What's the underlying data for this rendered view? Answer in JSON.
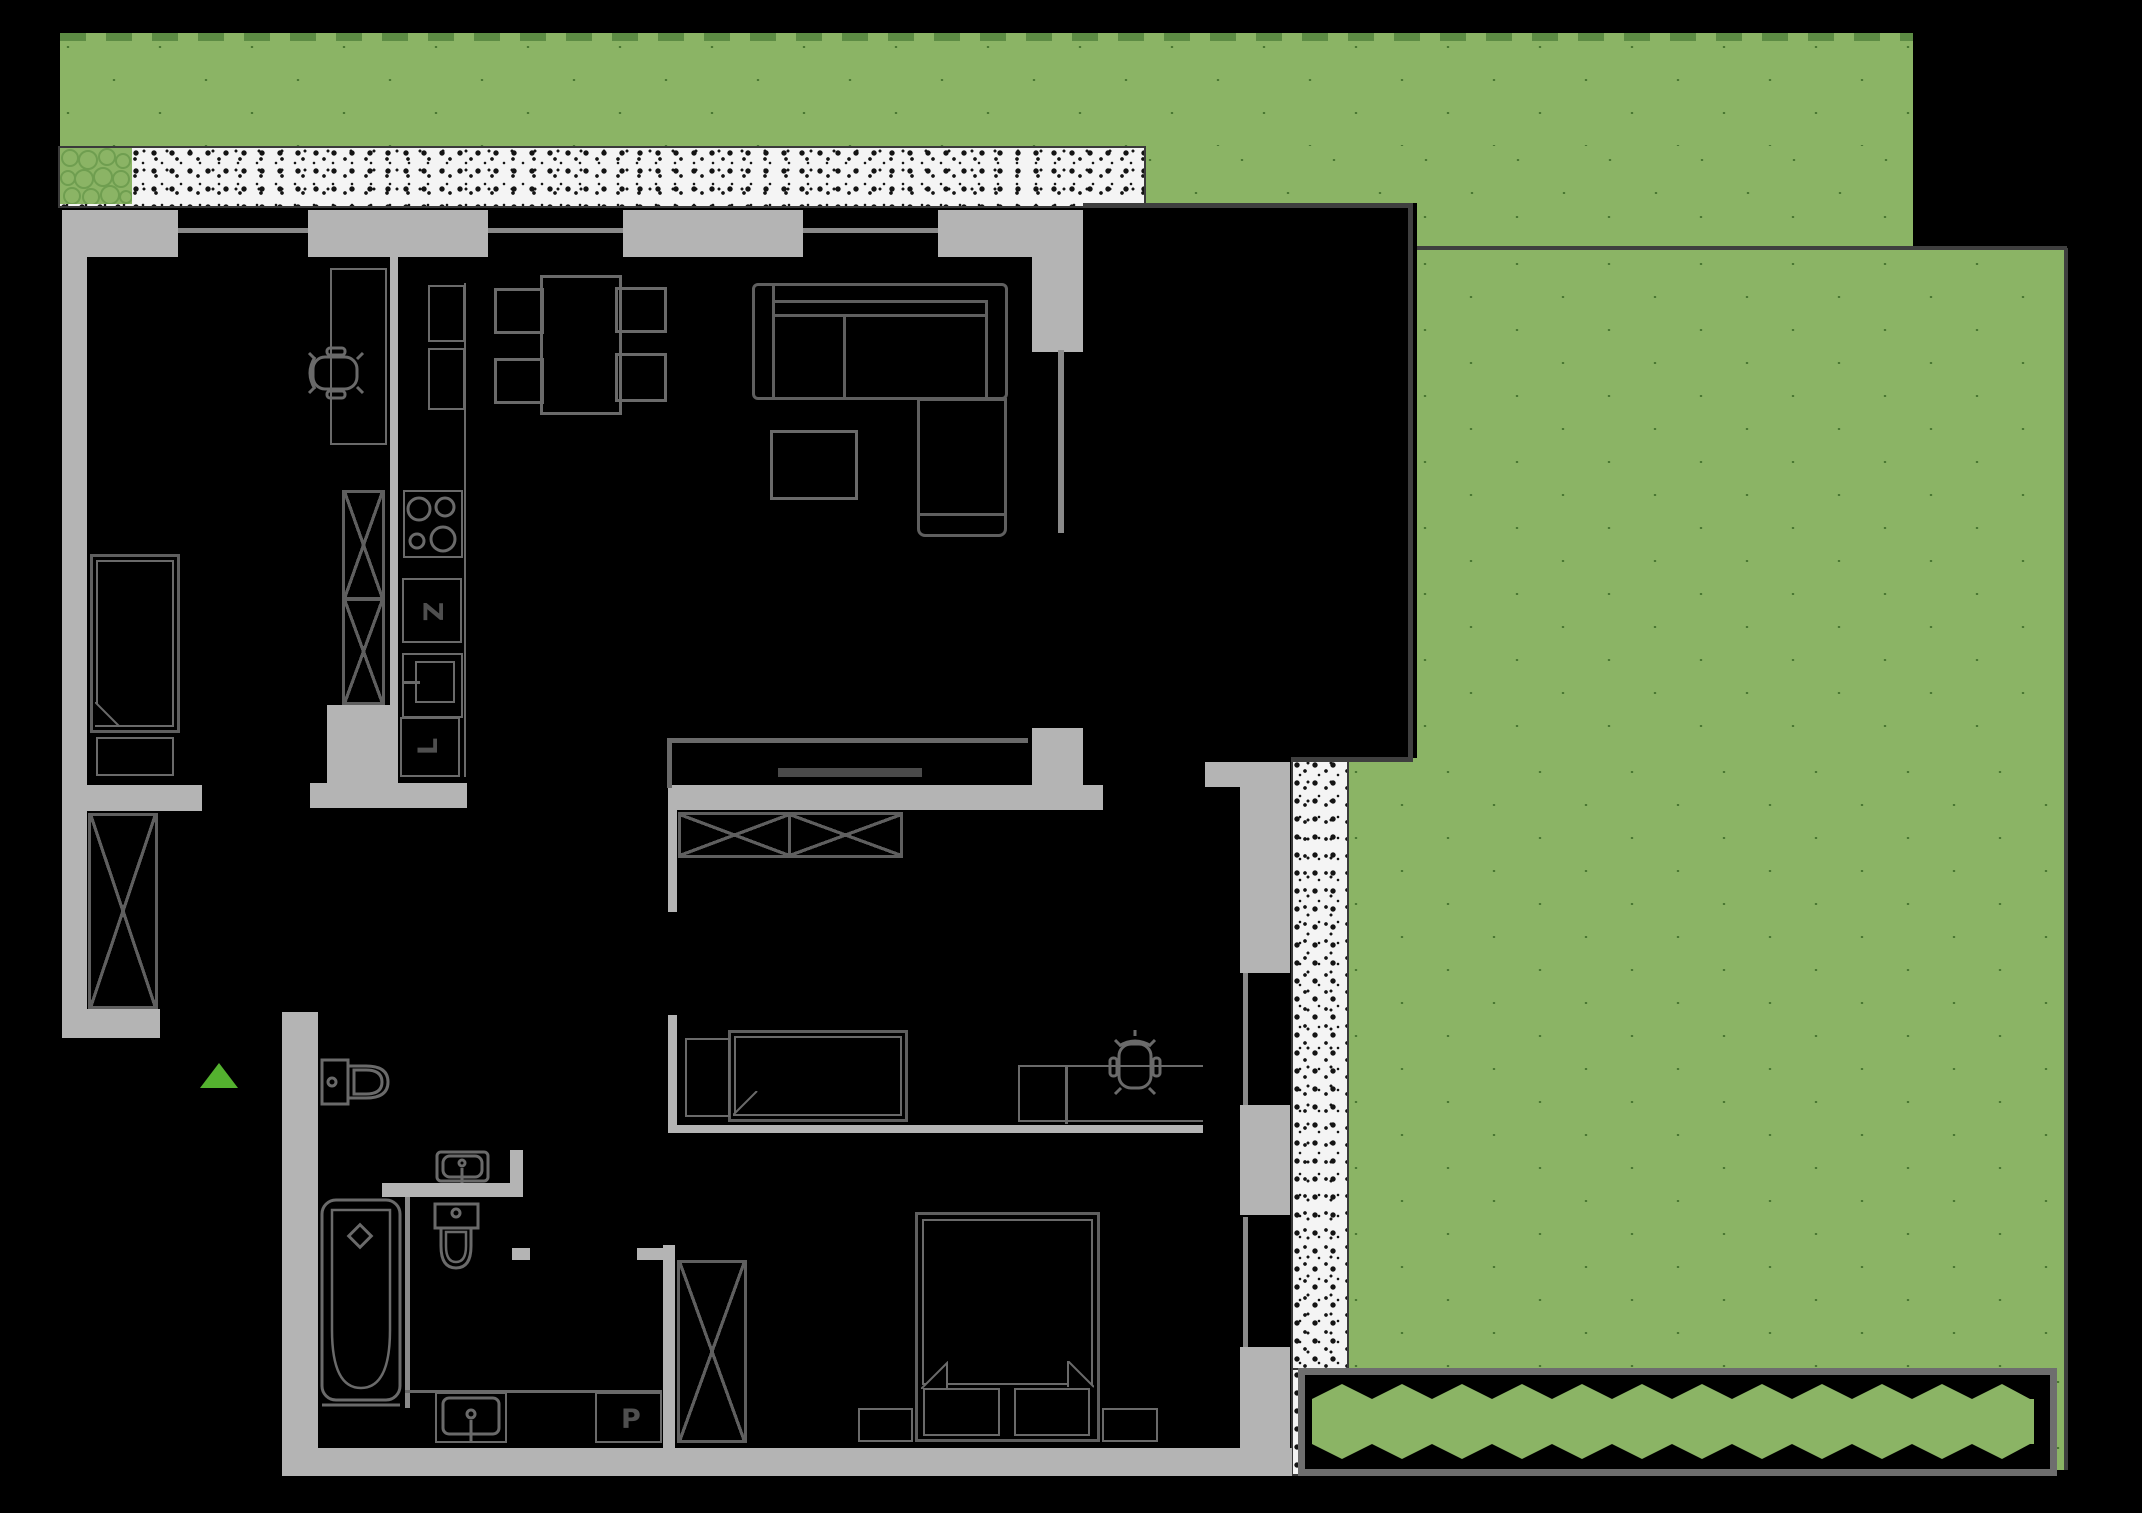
{
  "plan": {
    "appliance_labels": {
      "z": "Z",
      "l": "L",
      "p": "P"
    },
    "colors": {
      "background": "#000000",
      "wall_gray": "#b4b4b4",
      "wall_outline_dark": "#3f3f3f",
      "lawn_green": "#8bb465",
      "lawn_dot": "#42702c",
      "lawn_edge_dash": "#5d8c44",
      "terrace_hatch_bg": "#f4f4f4",
      "terrace_hatch_dot": "#141414",
      "furniture_stroke": "#5f5f5f",
      "entrance_triangle": "#54b22f",
      "planter_green": "#8bb465"
    },
    "icon_names": [
      "lawn-area",
      "terrace-hatch-strip",
      "shrub-patch",
      "planter-box",
      "entrance-triangle-icon",
      "bed-single",
      "bed-double",
      "bed-study",
      "wardrobe-xbox",
      "dining-table",
      "dining-chair",
      "sofa",
      "chaise",
      "coffee-table",
      "desk",
      "office-chair-icon",
      "kitchen-counter",
      "hob-icon",
      "sink-icon",
      "toilet-icon",
      "washbasin-icon",
      "bathtub-icon",
      "washing-machine"
    ]
  }
}
